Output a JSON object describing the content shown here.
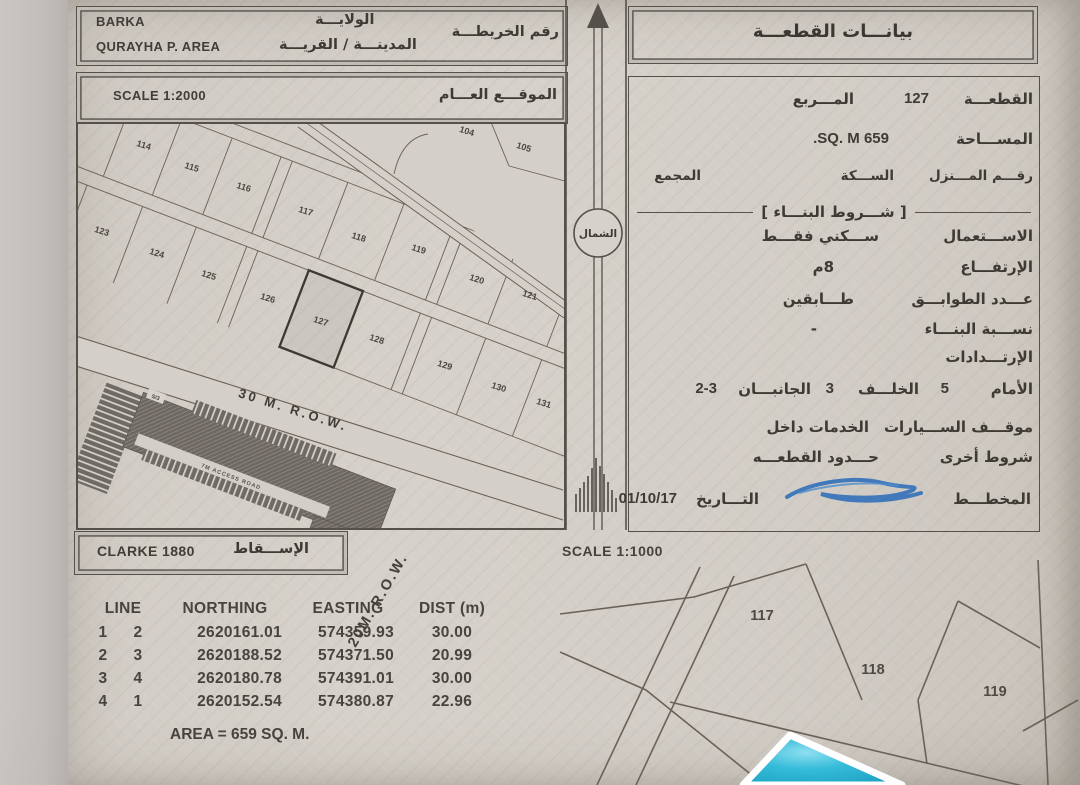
{
  "header": {
    "region_en": "BARKA",
    "region_label_ar": "الولايـــة",
    "area_en": "QURAYHA P. AREA",
    "area_label_ar": "المدينـــة / القريـــة",
    "map_no_label_ar": "رقم الخريطـــة"
  },
  "site_map": {
    "scale": "SCALE 1:2000",
    "title_ar": "الموقـــع العـــام",
    "road_label": "30 M. R.O.W.",
    "access_road_label": "7M ACCESS ROAD",
    "complex_tags": [
      "S/3",
      "152"
    ],
    "plots": [
      {
        "n": "114",
        "x": 67,
        "y": 26
      },
      {
        "n": "115",
        "x": 115,
        "y": 48
      },
      {
        "n": "116",
        "x": 167,
        "y": 68
      },
      {
        "n": "117",
        "x": 229,
        "y": 92
      },
      {
        "n": "118",
        "x": 282,
        "y": 118
      },
      {
        "n": "119",
        "x": 342,
        "y": 130
      },
      {
        "n": "104",
        "x": 390,
        "y": 12
      },
      {
        "n": "105",
        "x": 447,
        "y": 28
      },
      {
        "n": "120",
        "x": 400,
        "y": 160
      },
      {
        "n": "121",
        "x": 453,
        "y": 176
      },
      {
        "n": "123",
        "x": 25,
        "y": 112
      },
      {
        "n": "124",
        "x": 80,
        "y": 134
      },
      {
        "n": "125",
        "x": 132,
        "y": 156
      },
      {
        "n": "126",
        "x": 191,
        "y": 179
      },
      {
        "n": "127",
        "x": 244,
        "y": 202
      },
      {
        "n": "128",
        "x": 300,
        "y": 220
      },
      {
        "n": "129",
        "x": 368,
        "y": 246
      },
      {
        "n": "130",
        "x": 422,
        "y": 268
      },
      {
        "n": "131",
        "x": 467,
        "y": 284
      }
    ]
  },
  "north": {
    "label_ar": "الشمال"
  },
  "panel": {
    "title_ar": "بيانـــات القطعـــة",
    "plot_label": "القطعـــة",
    "plot_value": "127",
    "square_label": "المـــربع",
    "area_label": "المســـاحة",
    "area_value": "659 SQ. M.",
    "house_label": "رقـــم المـــنزل",
    "street_label": "الســـكة",
    "block_label": "المجمع",
    "conditions_title": "شـــروط البنـــاء",
    "use_label": "الاســـتعمال",
    "use_value": "ســـكني فقـــط",
    "height_label": "الإرتفـــاع",
    "height_value": "8م",
    "floors_label": "عـــدد الطوابـــق",
    "floors_value": "طـــابقين",
    "ratio_label": "نســـبة البنـــاء",
    "ratio_value": "-",
    "setbacks_label": "الإرتـــدادات",
    "front_label": "الأمام",
    "front_value": "5",
    "back_label": "الخلـــف",
    "back_value": "3",
    "sides_label": "الجانبـــان",
    "sides_value": "2-3",
    "parking_label": "موقـــف الســـيارات",
    "parking_value": "الخدمات داخل",
    "other_label": "شروط أخرى",
    "other_value": "حـــدود القطعـــه",
    "plan_label": "المخطـــط",
    "date_label": "التـــاريخ",
    "date_value": "01/10/17"
  },
  "projection": {
    "datum": "CLARKE 1880",
    "label_ar": "الإســـقاط"
  },
  "sketch": {
    "scale": "SCALE 1:1000",
    "road_label": "20M. R.O.W.",
    "plots": [
      {
        "n": "117",
        "x": 222,
        "y": 64
      },
      {
        "n": "118",
        "x": 333,
        "y": 118
      },
      {
        "n": "119",
        "x": 455,
        "y": 140
      }
    ]
  },
  "coords_table": {
    "headers": {
      "line": "LINE",
      "northing": "NORTHING",
      "easting": "EASTING",
      "dist": "DIST (m)"
    },
    "rows": [
      [
        "1",
        "2",
        "2620161.01",
        "574359.93",
        "30.00"
      ],
      [
        "2",
        "3",
        "2620188.52",
        "574371.50",
        "20.99"
      ],
      [
        "3",
        "4",
        "2620180.78",
        "574391.01",
        "30.00"
      ],
      [
        "4",
        "1",
        "2620152.54",
        "574380.87",
        "22.96"
      ]
    ],
    "area_note": "AREA = 659 SQ. M."
  },
  "colors": {
    "paper": "#d3cec7",
    "ink": "#46423c",
    "highlight_cyan": "#35bcd9",
    "signature_blue": "#2e6db8"
  }
}
